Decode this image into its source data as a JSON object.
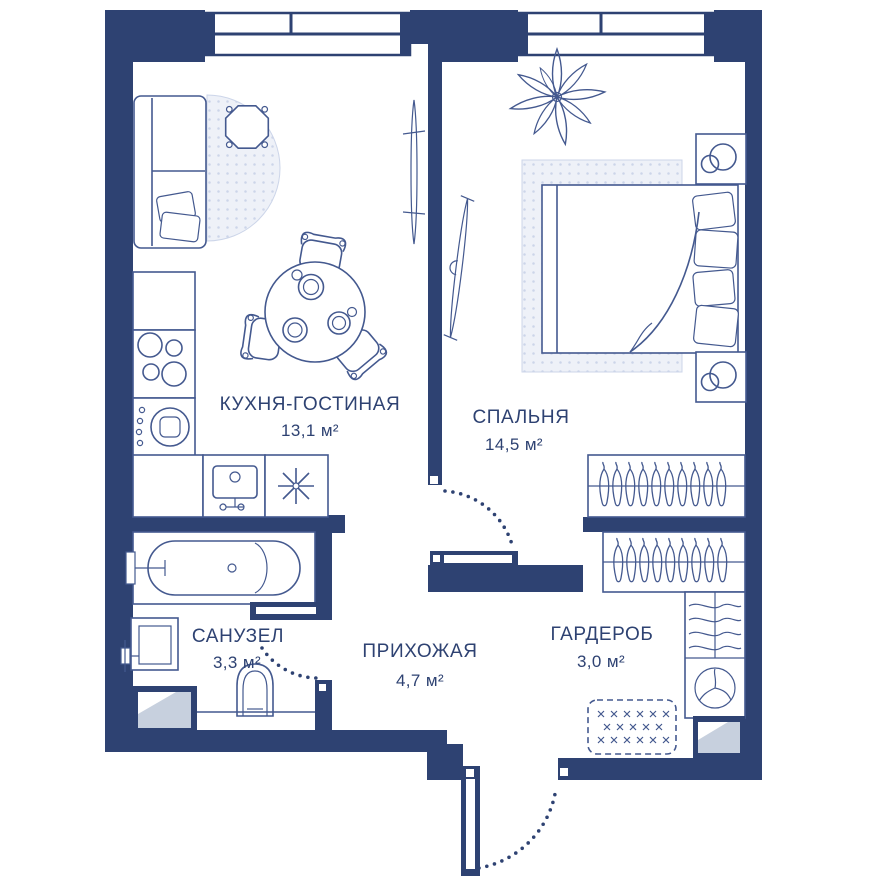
{
  "plan": {
    "title": "Однокомнатная квартира — план",
    "rooms": [
      {
        "id": "kitchen-living",
        "label": "КУХНЯ-ГОСТИНАЯ",
        "area": "13,1 м²"
      },
      {
        "id": "bedroom",
        "label": "СПАЛЬНЯ",
        "area": "14,5 м²"
      },
      {
        "id": "bathroom",
        "label": "САНУЗЕЛ",
        "area": "3,3 м²"
      },
      {
        "id": "hallway",
        "label": "ПРИХОЖАЯ",
        "area": "4,7 м²"
      },
      {
        "id": "wardrobe",
        "label": "ГАРДЕРОБ",
        "area": "3,0 м²"
      }
    ],
    "icons": [
      "window-icon",
      "entrance-door-icon",
      "interior-door-icon",
      "bathtub-icon",
      "toilet-icon",
      "washbasin-icon",
      "washing-machine-icon",
      "hob-icon",
      "kitchen-sink-icon",
      "fridge-snowflake-icon",
      "sofa-icon",
      "coffee-table-icon",
      "dining-table-icon",
      "chair-icon",
      "tv-icon",
      "plant-icon",
      "bed-icon",
      "nightstand-lamp-icon",
      "closet-hangers-icon",
      "shelf-clothes-icon",
      "fan-icon",
      "doormat-icon",
      "shaft-icon"
    ]
  },
  "palette": {
    "wall": "#2e4272",
    "line": "#44598f",
    "text": "#2e4272",
    "rug_fill": "#eef1f8",
    "rug_dot": "#ccd5e9",
    "shaft_fill": "#c7d0de",
    "background": "#ffffff"
  }
}
